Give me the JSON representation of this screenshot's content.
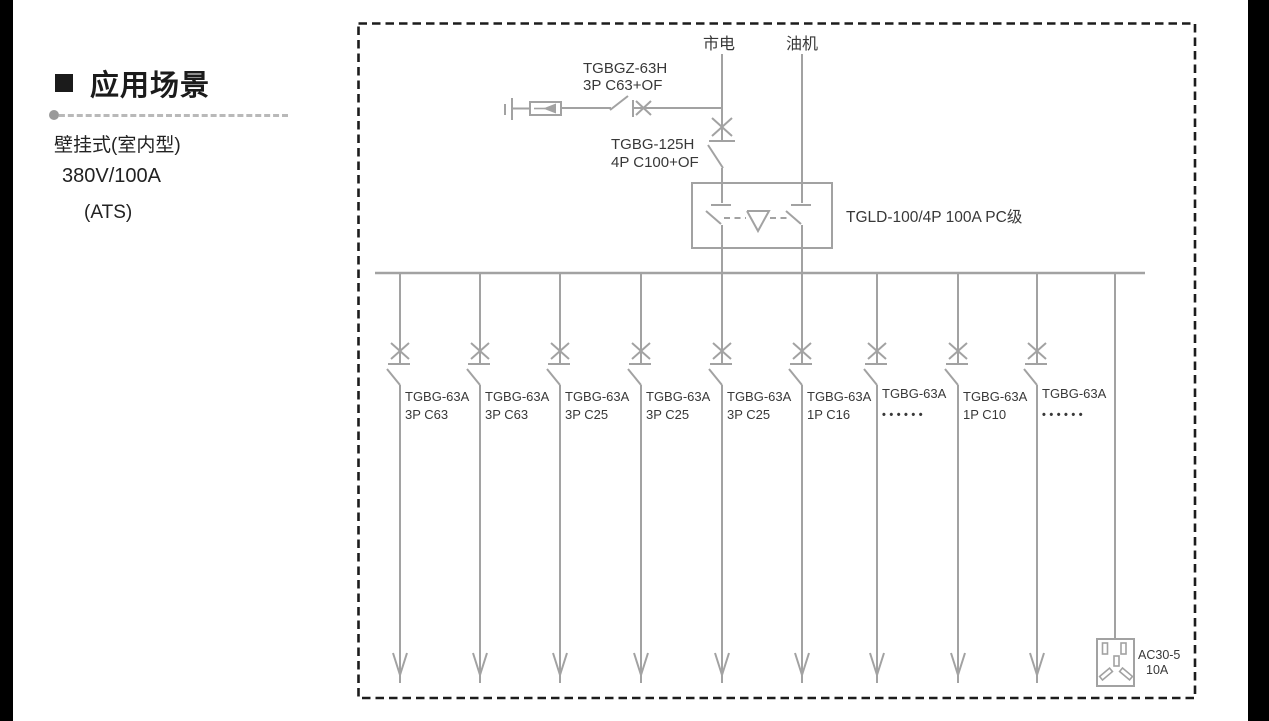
{
  "colors": {
    "line_gray": "#a2a2a2",
    "diagram_text": "#383838",
    "border_black": "#1c1c1c",
    "panel_text": "#1b1b1b"
  },
  "left_panel": {
    "section_title": "应用场景",
    "lines": [
      "壁挂式(室内型)",
      "380V/100A",
      "(ATS)"
    ]
  },
  "diagram": {
    "source_mains": "市电",
    "source_generator": "油机",
    "spd_breaker": {
      "model": "TGBGZ-63H",
      "spec": "3P C63+OF"
    },
    "main_breaker": {
      "model": "TGBG-125H",
      "spec": "4P C100+OF"
    },
    "ats_label": "TGLD-100/4P 100A PC级",
    "feeders": [
      {
        "model": "TGBG-63A",
        "spec": "3P C63"
      },
      {
        "model": "TGBG-63A",
        "spec": "3P C63"
      },
      {
        "model": "TGBG-63A",
        "spec": "3P C25"
      },
      {
        "model": "TGBG-63A",
        "spec": "3P C25"
      },
      {
        "model": "TGBG-63A",
        "spec": "3P C25"
      },
      {
        "model": "TGBG-63A",
        "spec": "1P C16"
      },
      {
        "model": "TGBG-63A",
        "spec": "••••••"
      },
      {
        "model": "TGBG-63A",
        "spec": "1P C10"
      },
      {
        "model": "TGBG-63A",
        "spec": "••••••"
      }
    ],
    "socket": {
      "model": "AC30-5",
      "rating": "10A"
    }
  }
}
